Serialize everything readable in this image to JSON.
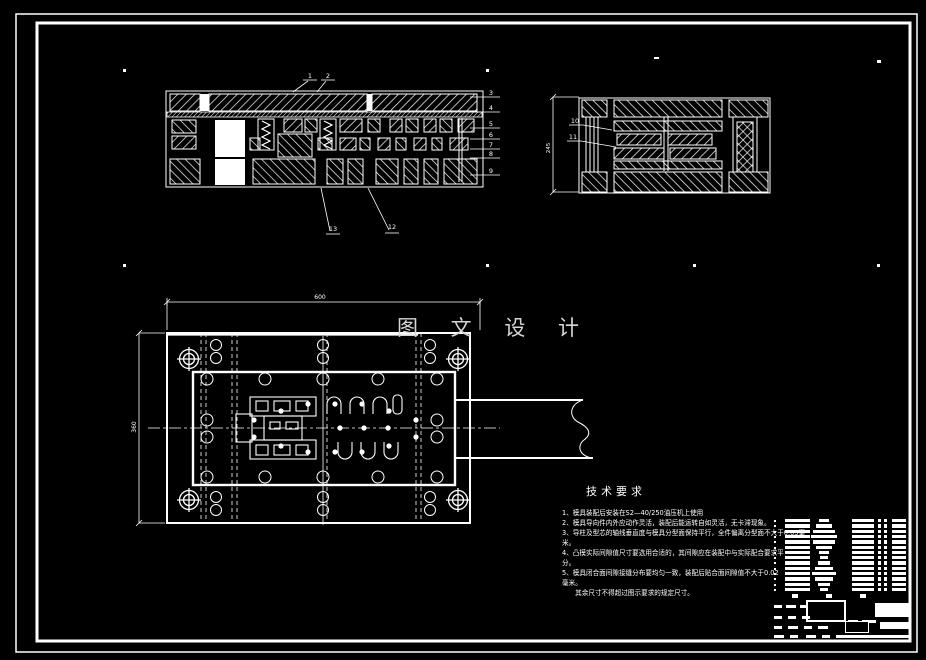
{
  "drawing": {
    "watermark": "图 文 设 计",
    "balloons": {
      "b1": "1",
      "b2": "2",
      "b3": "3",
      "b4": "4",
      "b5": "5",
      "b6": "6",
      "b7": "7",
      "b8": "8",
      "b9": "9",
      "b10": "10",
      "b11": "11",
      "b12": "12",
      "b13": "13"
    },
    "dimensions": {
      "plan_width": "600",
      "plan_height": "360",
      "section_height": "245"
    }
  },
  "tech": {
    "title": "技术要求",
    "lines": [
      "1、模具装配后安装在S2—40/250油压机上使用",
      "2、模具导向件内外应动作灵活，装配后能运转自如灵活，无卡滞现象。",
      "3、导柱及型芯的轴线垂直度与模具分型面保持平行，全件偏离分型面不大于0.03毫",
      "米。",
      "4、凸模实际间隙值尺寸要选用合适的，其间隙应在装配中与实际配合要求平",
      "分。",
      "5、模具闭合面间隙接缝分布要均匀一致，装配后贴合面间隙值不大于0.02",
      "毫米。",
      "　　其余尺寸不得超过图示要求的规定尺寸。"
    ]
  },
  "parts_table": {
    "rows": 14,
    "spec_bar_widths": [
      10,
      16,
      22,
      26,
      22,
      16,
      10,
      8,
      12,
      18,
      24,
      18,
      12,
      8
    ]
  },
  "colors": {
    "line": "#ffffff",
    "watermark": "#d6d6d6",
    "background": "#000000"
  }
}
